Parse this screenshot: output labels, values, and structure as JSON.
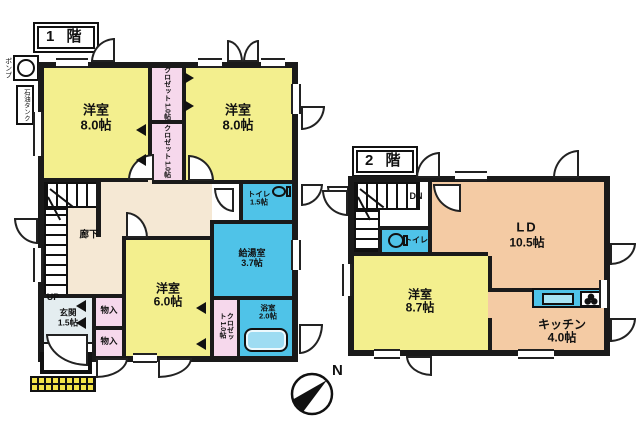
{
  "floor1": {
    "title": "1 階",
    "pump_label": "ポンプ",
    "oil_tank_label": "石油タンク",
    "up_label": "UP",
    "rooms": {
      "bedroom_nw": {
        "name": "洋室",
        "size": "8.0帖"
      },
      "bedroom_ne": {
        "name": "洋室",
        "size": "8.0帖"
      },
      "closet_top": {
        "name": "クロゼット",
        "size": "1.0帖"
      },
      "closet_mid": {
        "name": "クロゼット",
        "size": "1.0帖"
      },
      "hallway": {
        "name": "廊下"
      },
      "toilet": {
        "name": "トイレ",
        "size": "1.5帖"
      },
      "utility": {
        "name": "給湯室",
        "size": "3.7帖"
      },
      "bath": {
        "name": "浴室",
        "size": "2.0帖"
      },
      "closet_south": {
        "name": "クロゼット",
        "size": "1.0帖"
      },
      "bedroom_s": {
        "name": "洋室",
        "size": "6.0帖"
      },
      "entrance": {
        "name": "玄関",
        "size": "1.5帖"
      },
      "storage_upper": {
        "name": "物入"
      },
      "storage_lower": {
        "name": "物入"
      }
    }
  },
  "floor2": {
    "title": "2 階",
    "dn_label": "DN",
    "rooms": {
      "toilet": {
        "name": "トイレ"
      },
      "living_dining": {
        "name": "LD",
        "size": "10.5帖"
      },
      "bedroom": {
        "name": "洋室",
        "size": "8.7帖"
      },
      "kitchen": {
        "name": "キッチン",
        "size": "4.0帖"
      }
    }
  },
  "compass": {
    "north_label": "N"
  },
  "colors": {
    "room_yellow": "#f3ef8e",
    "closet_pink": "#f6d8ec",
    "wet_blue": "#4fc3e8",
    "hall_beige": "#f5e8d4",
    "living_peach": "#f4cba4",
    "entrance_gray": "#e4edf0",
    "porch_yellow": "#f3e34a",
    "wall": "#1a1a1a"
  }
}
